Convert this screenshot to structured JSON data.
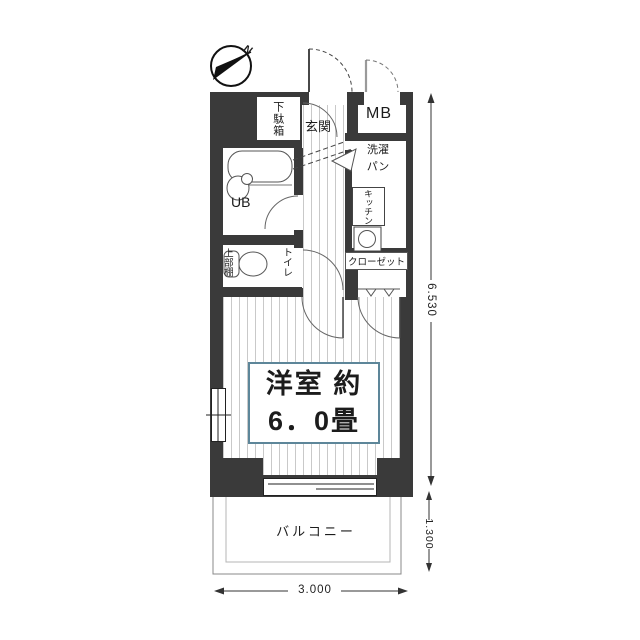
{
  "plan": {
    "compass": {
      "north_label": "N"
    },
    "labels": {
      "entrance": "玄関",
      "shoe_cabinet": "下駄箱",
      "unit_bath": "UB",
      "meter_box": "MB",
      "washer_pan": "洗濯\nパン",
      "kitchen": "キッチン",
      "toilet": "トイレ",
      "upper_shelf": "上部棚",
      "closet": "クローゼット",
      "main_room": "洋室\n約6．0畳",
      "balcony": "バルコニー"
    },
    "dimensions": {
      "total_depth": "6.530",
      "balcony_depth": "1.300",
      "width": "3.000"
    },
    "colors": {
      "wall": "#3a3a3a",
      "floor_stripe": "#c9c9c9",
      "room_label_border": "#5d8699",
      "line": "#3c3c3c"
    }
  }
}
